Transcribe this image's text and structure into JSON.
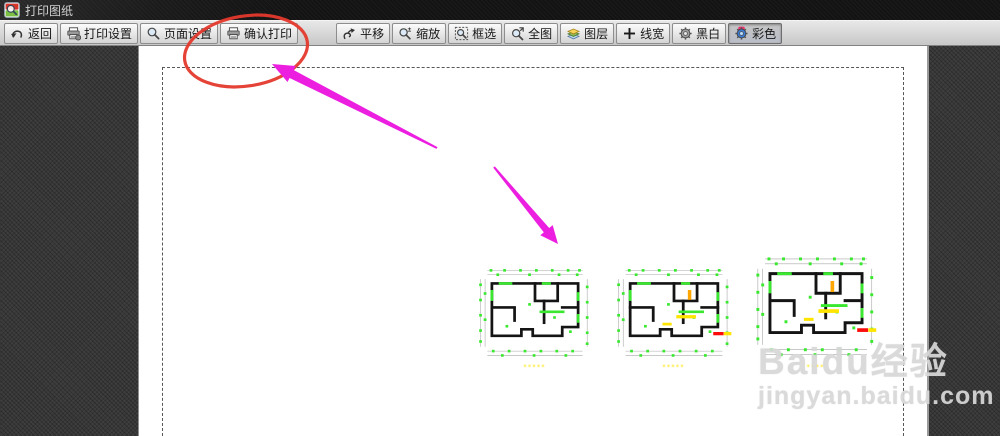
{
  "window": {
    "title": "打印图纸"
  },
  "toolbar": {
    "left": [
      {
        "id": "back",
        "label": "返回",
        "icon": "back-icon"
      },
      {
        "id": "print-settings",
        "label": "打印设置",
        "icon": "print-settings-icon"
      },
      {
        "id": "page-setup",
        "label": "页面设置",
        "icon": "page-setup-icon"
      },
      {
        "id": "confirm-print",
        "label": "确认打印",
        "icon": "confirm-print-icon",
        "highlighted": true
      }
    ],
    "right": [
      {
        "id": "pan",
        "label": "平移",
        "icon": "pan-icon"
      },
      {
        "id": "zoom",
        "label": "缩放",
        "icon": "zoom-icon"
      },
      {
        "id": "box-select",
        "label": "框选",
        "icon": "box-select-icon"
      },
      {
        "id": "full-view",
        "label": "全图",
        "icon": "full-view-icon"
      },
      {
        "id": "layers",
        "label": "图层",
        "icon": "layers-icon"
      },
      {
        "id": "line-width",
        "label": "线宽",
        "icon": "line-width-icon"
      },
      {
        "id": "black-white",
        "label": "黑白",
        "icon": "bw-gear-icon"
      },
      {
        "id": "color",
        "label": "彩色",
        "icon": "color-gear-icon",
        "selected": true
      }
    ]
  },
  "canvas": {
    "plans": [
      {
        "name": "floor-plan-1",
        "label": "▪▪▪▪▪",
        "accent": false,
        "redbar": false
      },
      {
        "name": "floor-plan-2",
        "label": "▪▪▪▪▪",
        "accent": true,
        "redbar": true
      },
      {
        "name": "floor-plan-3",
        "label": "▪▪▪▪",
        "accent": true,
        "redbar": true
      }
    ]
  },
  "watermark": {
    "line1": "Baidu经验",
    "line2": "jingyan.baidu.com"
  },
  "annotation": {
    "target": "确认打印"
  },
  "colors": {
    "annotation_ellipse": "#e4392c",
    "annotation_arrow": "#ec1fe1",
    "canvas_bg": "#3e3e3e",
    "plan_green": "#39e82f",
    "plan_yellow": "#ffe400",
    "plan_orange": "#ffa600",
    "plan_red": "#fb0b0b"
  }
}
